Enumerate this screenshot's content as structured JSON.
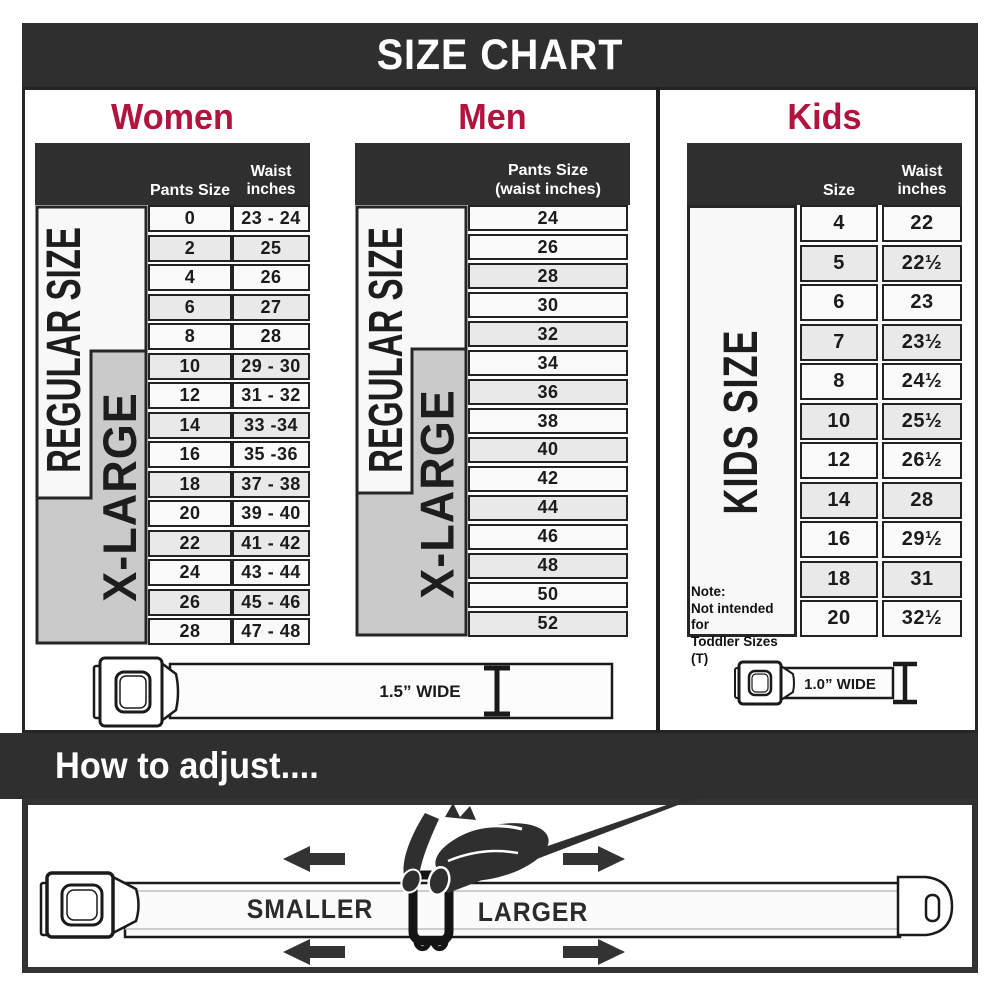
{
  "banner": {
    "title": "SIZE CHART"
  },
  "women": {
    "title": "Women",
    "header_col1": "Pants Size",
    "header_col2_line1": "Waist",
    "header_col2_line2": "inches",
    "zone_regular": "REGULAR SIZE",
    "zone_xlarge": "X-LARGE",
    "rows": [
      {
        "size": "0",
        "waist": "23 - 24"
      },
      {
        "size": "2",
        "waist": "25"
      },
      {
        "size": "4",
        "waist": "26"
      },
      {
        "size": "6",
        "waist": "27"
      },
      {
        "size": "8",
        "waist": "28"
      },
      {
        "size": "10",
        "waist": "29 - 30"
      },
      {
        "size": "12",
        "waist": "31 - 32"
      },
      {
        "size": "14",
        "waist": "33 -34"
      },
      {
        "size": "16",
        "waist": "35 -36"
      },
      {
        "size": "18",
        "waist": "37 - 38"
      },
      {
        "size": "20",
        "waist": "39 - 40"
      },
      {
        "size": "22",
        "waist": "41 - 42"
      },
      {
        "size": "24",
        "waist": "43 - 44"
      },
      {
        "size": "26",
        "waist": "45 - 46"
      },
      {
        "size": "28",
        "waist": "47 - 48"
      }
    ]
  },
  "men": {
    "title": "Men",
    "header_line1": "Pants Size",
    "header_line2": "(waist inches)",
    "zone_regular": "REGULAR SIZE",
    "zone_xlarge": "X-LARGE",
    "rows": [
      "24",
      "26",
      "28",
      "30",
      "32",
      "34",
      "36",
      "38",
      "40",
      "42",
      "44",
      "46",
      "48",
      "50",
      "52"
    ]
  },
  "kids": {
    "title": "Kids",
    "header_col1": "Size",
    "header_col2_line1": "Waist",
    "header_col2_line2": "inches",
    "zone": "KIDS SIZE",
    "note_line1": "Note:",
    "note_line2": "Not intended for",
    "note_line3": "Toddler Sizes (T)",
    "rows": [
      {
        "size": "4",
        "waist": "22"
      },
      {
        "size": "5",
        "waist": "22½"
      },
      {
        "size": "6",
        "waist": "23"
      },
      {
        "size": "7",
        "waist": "23½"
      },
      {
        "size": "8",
        "waist": "24½"
      },
      {
        "size": "10",
        "waist": "25½"
      },
      {
        "size": "12",
        "waist": "26½"
      },
      {
        "size": "14",
        "waist": "28"
      },
      {
        "size": "16",
        "waist": "29½"
      },
      {
        "size": "18",
        "waist": "31"
      },
      {
        "size": "20",
        "waist": "32½"
      }
    ]
  },
  "belts": {
    "adult_label": "1.5” WIDE",
    "kids_label": "1.0” WIDE"
  },
  "adjust": {
    "heading": "How to adjust....",
    "smaller": "SMALLER",
    "larger": "LARGER"
  },
  "colors": {
    "accent": "#b0143f",
    "charcoal": "#2f2f30",
    "zone_gray": "#cacaca"
  }
}
